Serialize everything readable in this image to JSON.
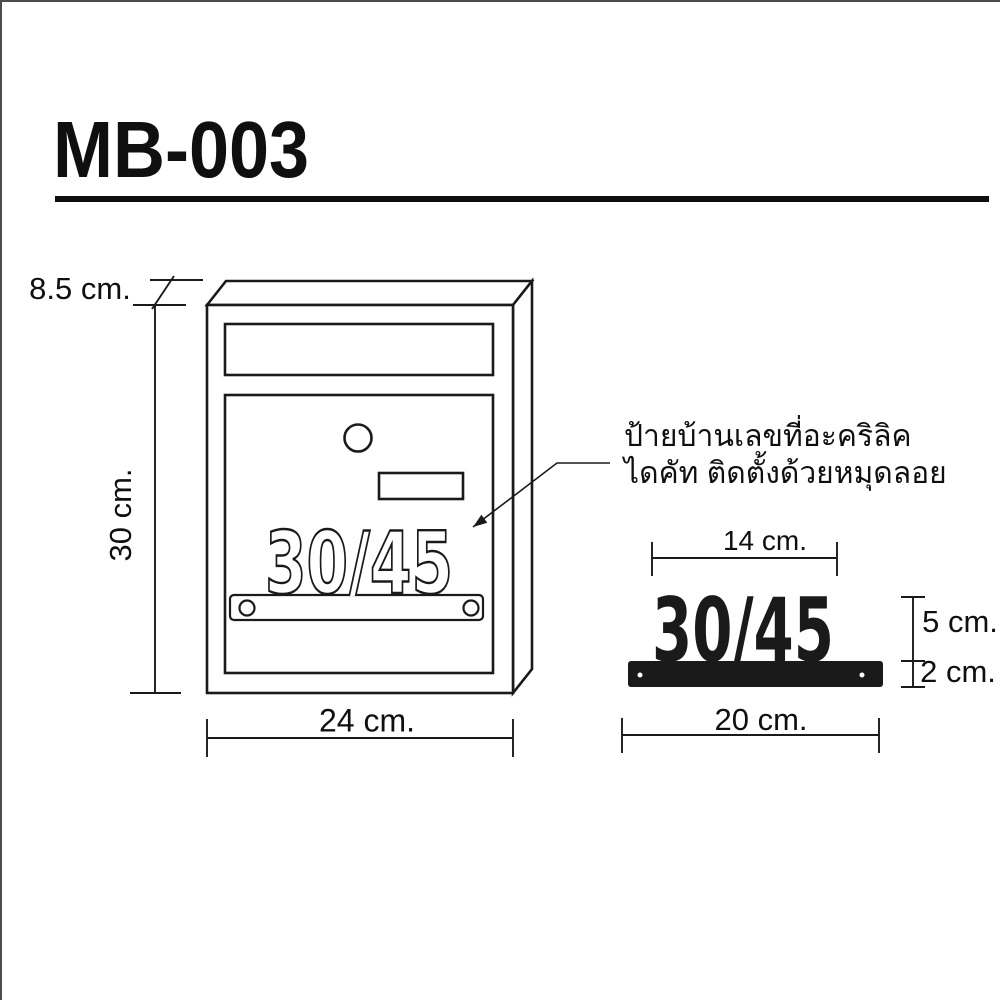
{
  "title": "MB-003",
  "mailbox_view": {
    "depth_label": "8.5 cm.",
    "height_label": "30 cm.",
    "width_label": "24 cm.",
    "plate_number": "30/45"
  },
  "callout": {
    "line1": "ป้ายบ้านเลขที่อะคริลิค",
    "line2": "ไดคัท ติดตั้งด้วยหมุดลอย"
  },
  "plate_detail": {
    "number": "30/45",
    "number_width_label": "14 cm.",
    "number_height_label": "5 cm.",
    "bar_height_label": "2 cm.",
    "bar_width_label": "20 cm."
  },
  "colors": {
    "ink": "#1a1a1a",
    "edge_border": "#4d4d4d"
  }
}
